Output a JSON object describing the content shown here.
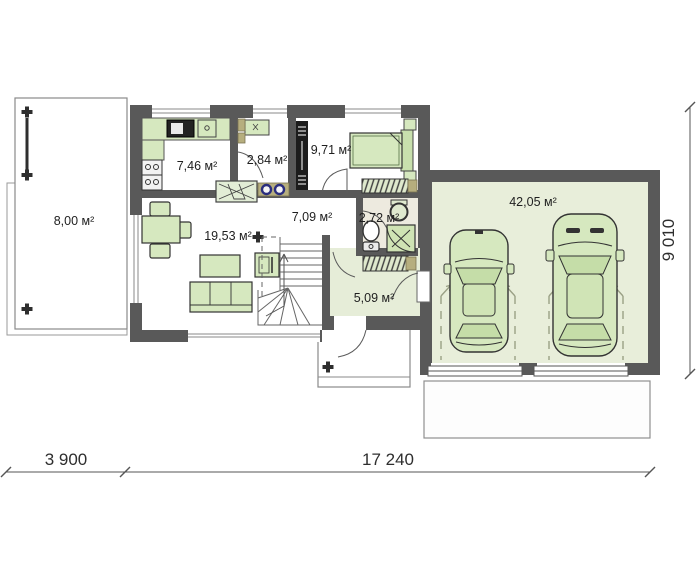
{
  "plan_title": "ground-floor-plan",
  "rooms": {
    "terrace": "8,00 м²",
    "kitchen": "7,46 м²",
    "pantry": "2,84 м²",
    "bedroom": "9,71 м²",
    "hall": "7,09 м²",
    "bathroom": "2,72 м²",
    "living": "19,53 м²",
    "vestibule": "5,09 м²",
    "garage": "42,05 м²"
  },
  "dimensions": {
    "bottom_left": "3 900",
    "bottom_right": "17 240",
    "right_side": "9 010"
  },
  "colors": {
    "wall": "#595959",
    "floor_green": "#e8eeda",
    "furniture_green": "#d6e8bf",
    "accent_khaki": "#b6ae7e",
    "accent_blue": "#2b2e7e"
  }
}
